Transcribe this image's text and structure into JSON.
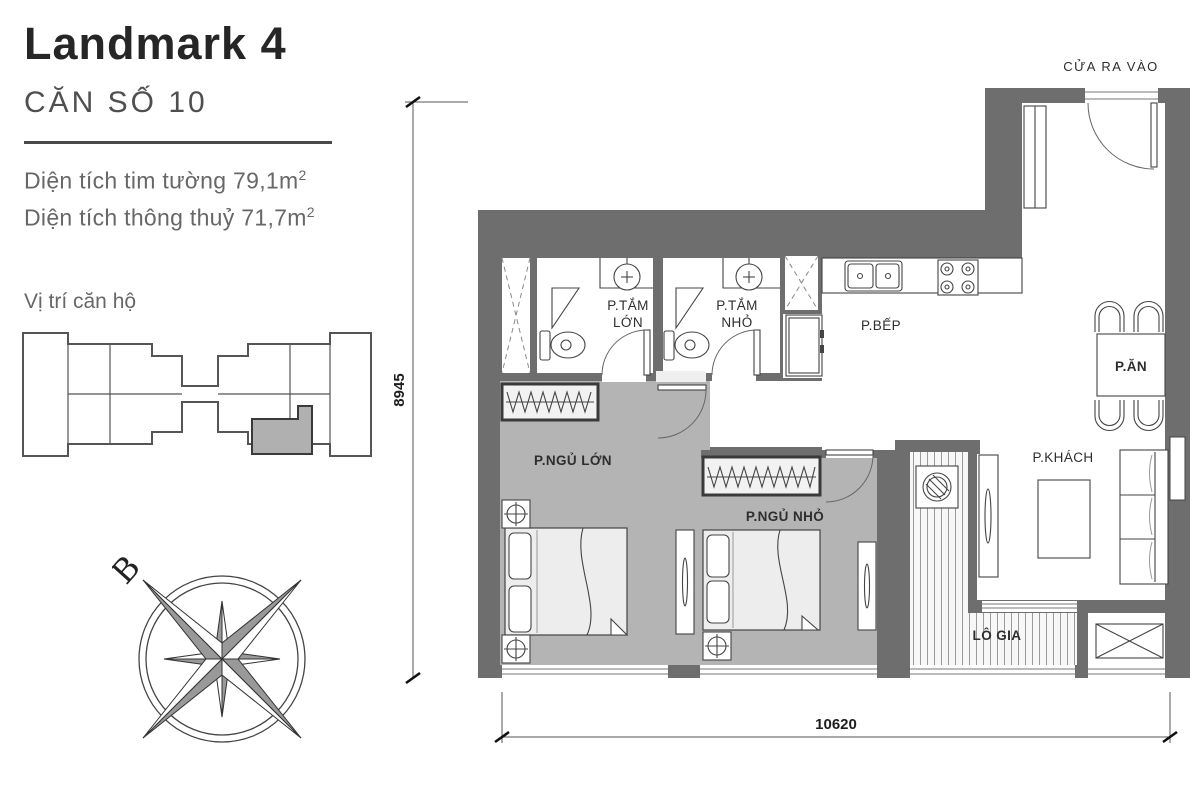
{
  "panel": {
    "title": "Landmark 4",
    "unit_label": "CĂN SỐ 10",
    "area_wall": "Diện tích tim tường 79,1m",
    "area_clear": "Diện tích thông thuỷ 71,7m",
    "area_sup": "2",
    "location_title": "Vị trí căn hộ",
    "compass_north": "B"
  },
  "plan": {
    "entrance_label": "CỬA RA VÀO",
    "dim_height": "8945",
    "dim_width": "10620",
    "rooms": {
      "bath_large_line1": "P.TẮM",
      "bath_large_line2": "LỚN",
      "bath_small_line1": "P.TẮM",
      "bath_small_line2": "NHỎ",
      "kitchen": "P.BẾP",
      "dining": "P.ĂN",
      "living": "P.KHÁCH",
      "bed_large": "P.NGỦ LỚN",
      "bed_small": "P.NGỦ NHỎ",
      "loggia": "LÔ GIA"
    }
  },
  "colors": {
    "wall": "#6e6e6e",
    "bedroom_floor": "#b4b4b4",
    "highlight_unit": "#b0b0b0",
    "line": "#444444"
  }
}
